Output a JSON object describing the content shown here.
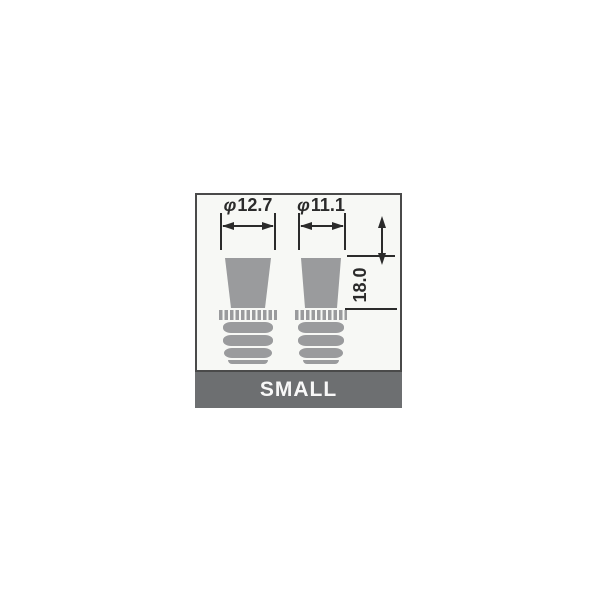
{
  "diagram": {
    "dimension_labels": {
      "left": {
        "symbol": "φ",
        "value": "12.7"
      },
      "right": {
        "symbol": "φ",
        "value": "11.1"
      },
      "height": {
        "value": "18.0"
      }
    },
    "footer": {
      "label": "SMALL"
    },
    "colors": {
      "part_fill": "#9a9b9d",
      "footer_bg": "#6d6f71",
      "line": "#2b2b2b",
      "panel_bg": "#f7f8f5",
      "panel_border": "#4a4a4a",
      "footer_text": "#f8f8f8"
    }
  }
}
